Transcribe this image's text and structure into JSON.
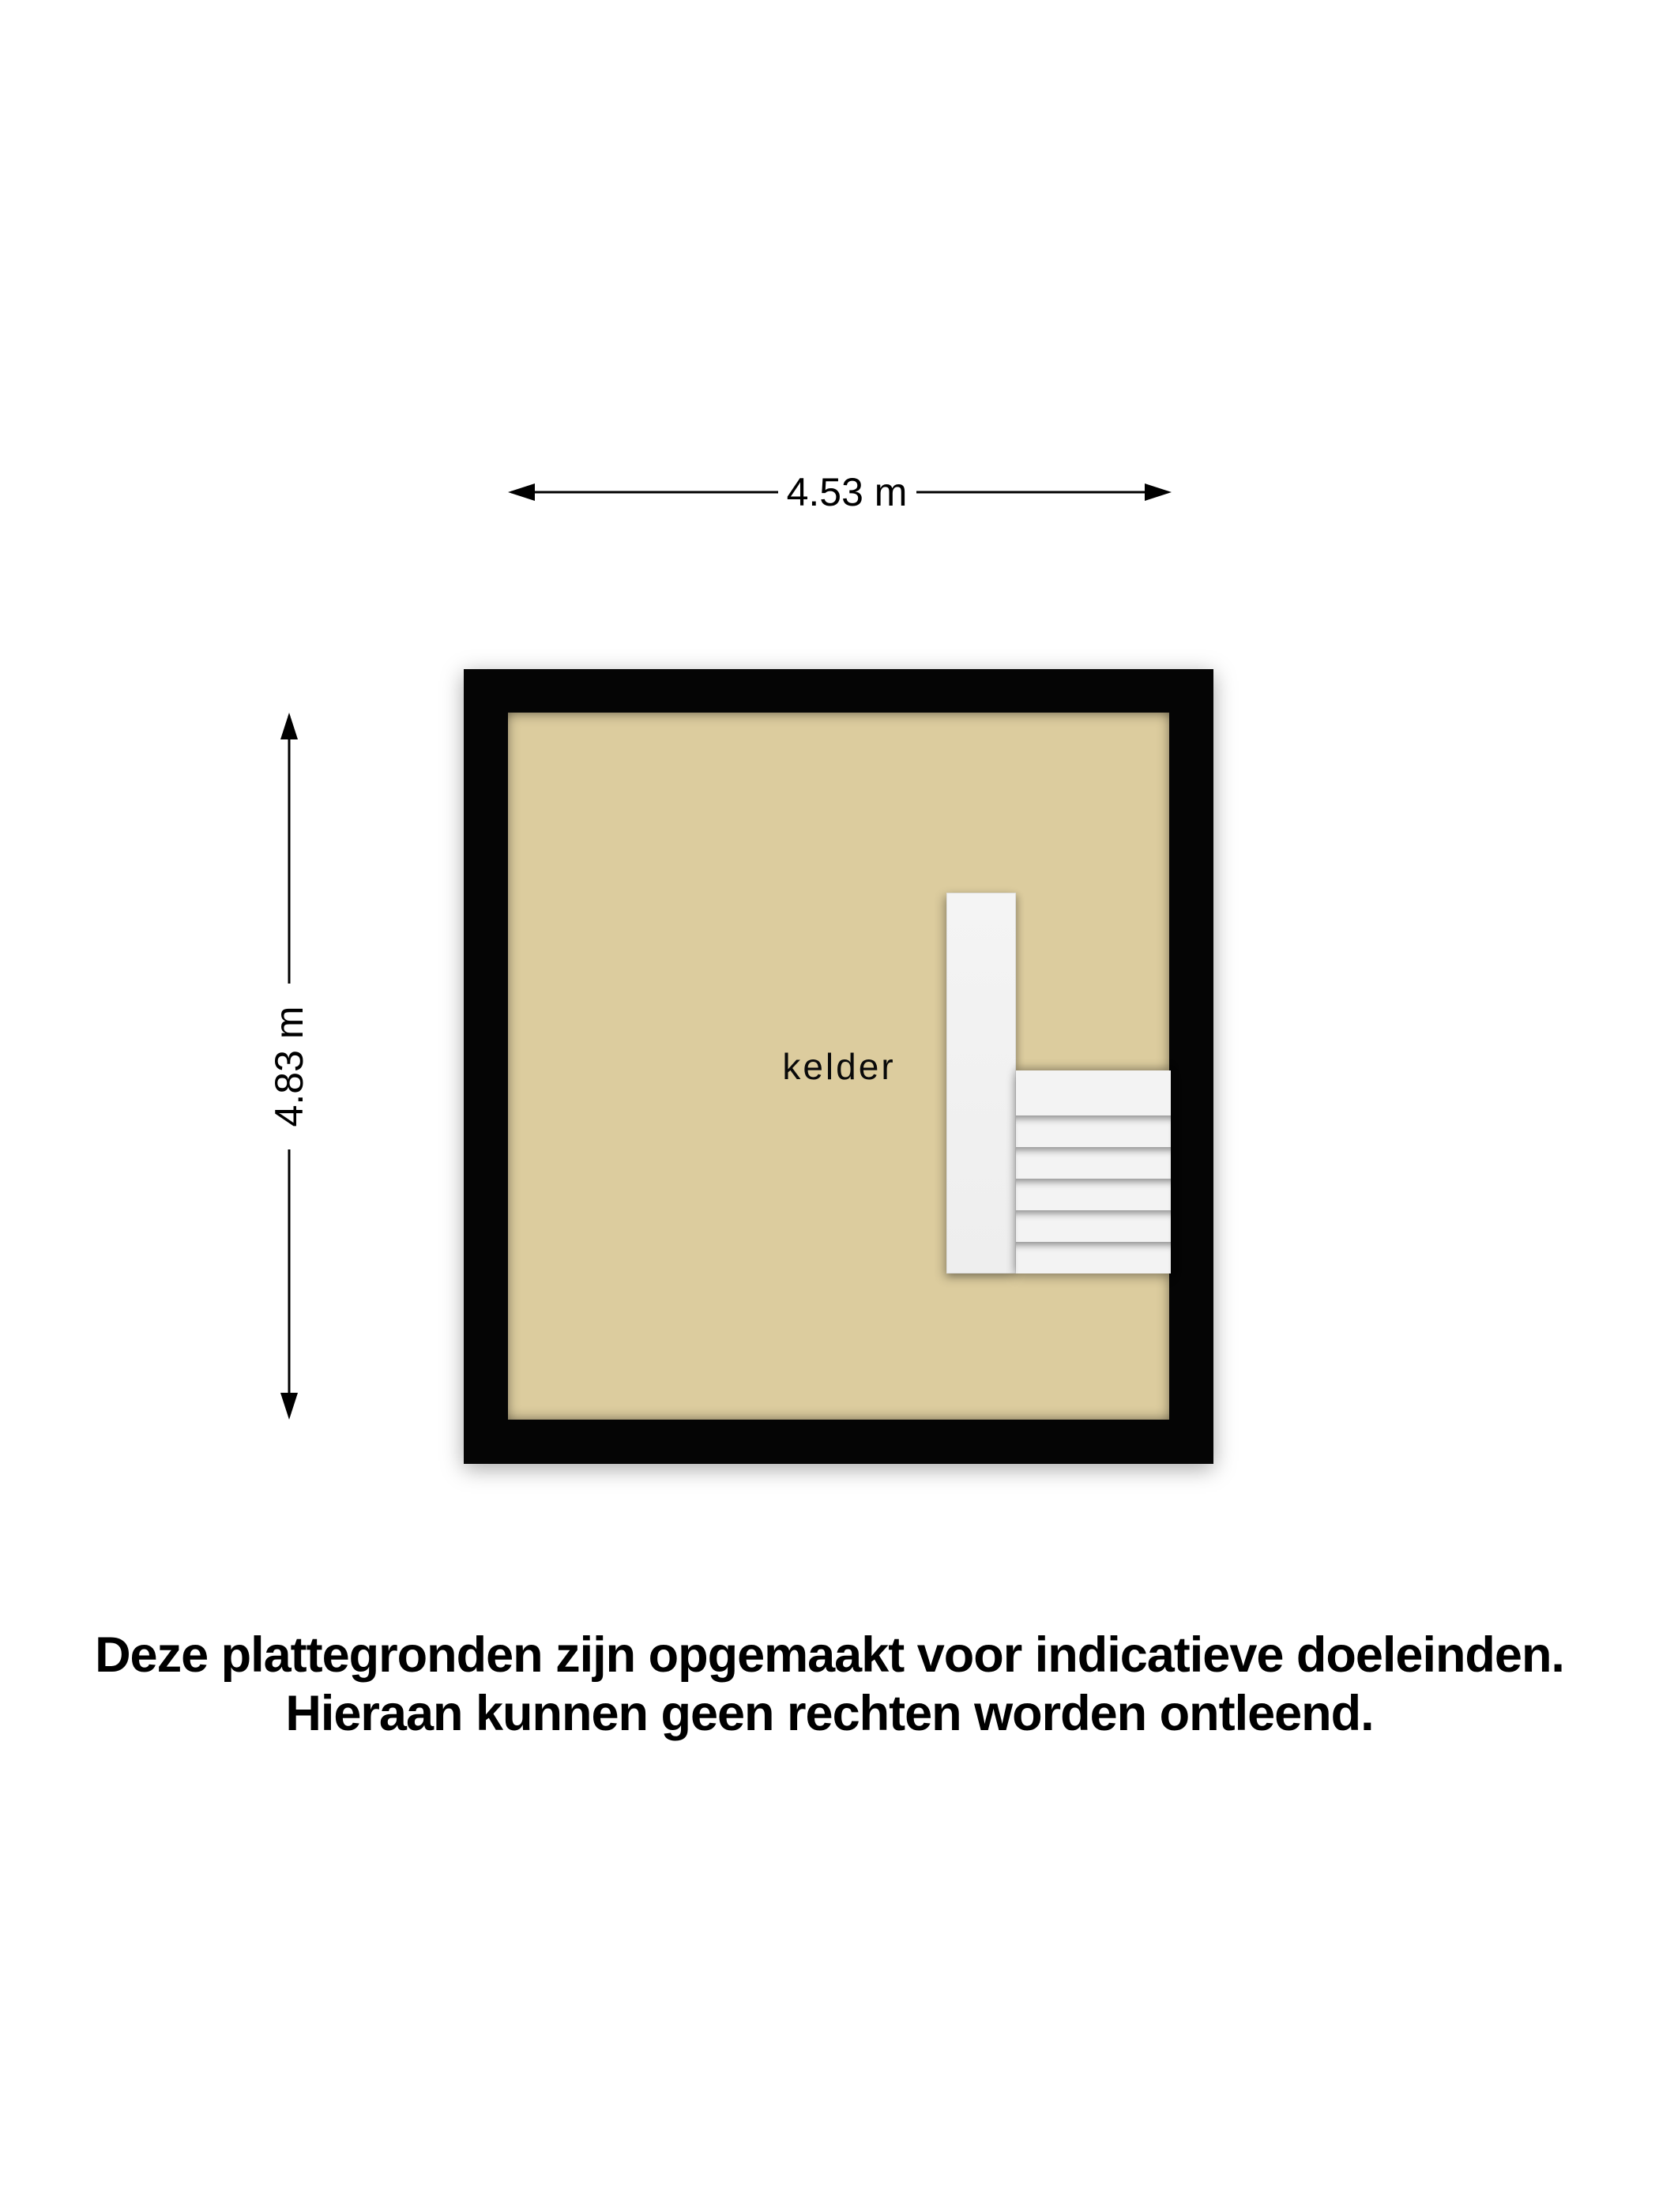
{
  "plan": {
    "room_label": "kelder",
    "dimensions": {
      "width": "4.53 m",
      "height": "4.83 m"
    },
    "stairs": {
      "tread_count": 6
    }
  },
  "disclaimer": {
    "line1": "Deze plattegronden zijn opgemaakt voor indicatieve doeleinden.",
    "line2": "Hieraan kunnen geen rechten worden ontleend."
  },
  "colors": {
    "background": "#ffffff",
    "wall": "#050505",
    "floor": "#dccc9e",
    "stairs": "#f3f3f3",
    "text": "#000000"
  }
}
